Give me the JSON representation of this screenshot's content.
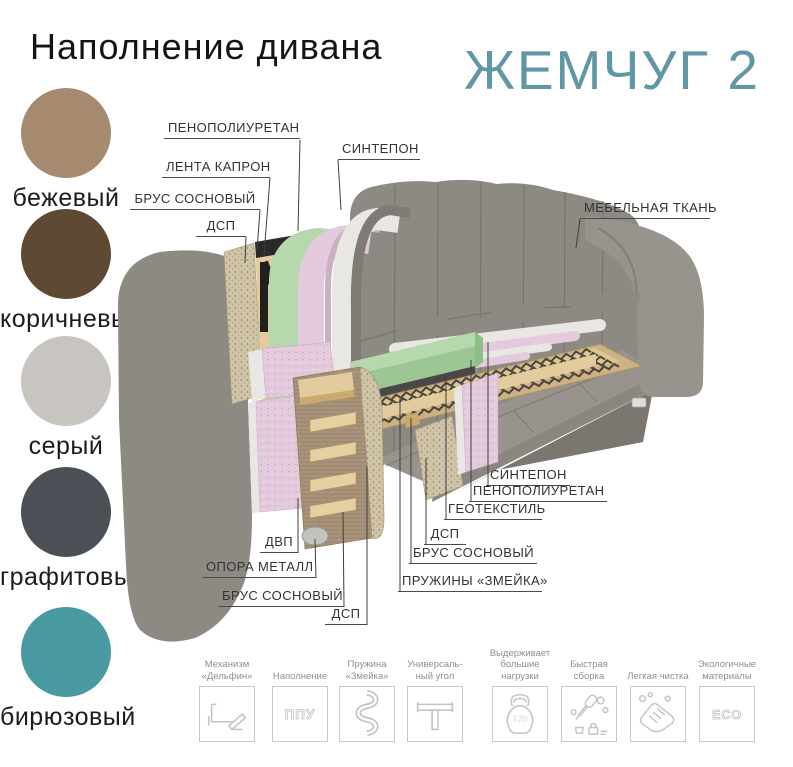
{
  "header": {
    "title": "Наполнение дивана",
    "product": "ЖЕМЧУГ 2"
  },
  "colors": {
    "product_teal": "#6097a4",
    "label_text": "#333333",
    "leader_line": "#3f3f3f",
    "sofa_gray": "#8d8983",
    "sofa_gray_light": "#98948d",
    "sofa_gray_dark": "#7b766f",
    "seam_gray": "#6b675f",
    "foam_green": "#b5d8ac",
    "foam_green_dark": "#9cc794",
    "foam_green_side": "#8fbe86",
    "foam_pink": "#e3cadd",
    "sintepon_white": "#e8e7e3",
    "fabric_edge_gray": "#7e7a74",
    "wood_light": "#e2cb9c",
    "wood_dark": "#c9a96c",
    "chipboard": "#cfc3a8",
    "fiberboard": "#a8937a",
    "strap_black": "#21201e",
    "geotextile_dark": "#4a4846",
    "metal": "#c2c2c0",
    "icon_line": "#c4c4c4",
    "icon_text_gray": "#8f8f8f",
    "box_border": "#c9c9c9"
  },
  "swatches": {
    "items": [
      {
        "label": "бежевый",
        "color": "#a58a6f"
      },
      {
        "label": "коричневый",
        "color": "#5e4a33"
      },
      {
        "label": "серый",
        "color": "#c8c4bf"
      },
      {
        "label": "графитовый",
        "color": "#4b5056"
      },
      {
        "label": "бирюзовый",
        "color": "#4999a1"
      }
    ]
  },
  "diagram": {
    "labels": {
      "pu_top": "ПЕНОПОЛИУРЕТАН",
      "sintepon_top": "СИНТЕПОН",
      "lenta_kapron": "ЛЕНТА КАПРОН",
      "brus_top": "БРУС СОСНОВЫЙ",
      "dsp_top": "ДСП",
      "fabric": "МЕБЕЛЬНАЯ ТКАНЬ",
      "sintepon_seat": "СИНТЕПОН",
      "pu_seat": "ПЕНОПОЛИУРЕТАН",
      "geotextile": "ГЕОТЕКСТИЛЬ",
      "dsp_seat": "ДСП",
      "brus_seat": "БРУС СОСНОВЫЙ",
      "springs": "ПРУЖИНЫ «ЗМЕЙКА»",
      "dvp": "ДВП",
      "opora": "ОПОРА МЕТАЛЛ",
      "brus_arm": "БРУС СОСНОВЫЙ",
      "dsp_arm": "ДСП"
    }
  },
  "features": {
    "items": [
      {
        "label": "Механизм\n«Дельфин»",
        "icon": "dolphin-mechanism-icon"
      },
      {
        "label": "Наполнение",
        "icon": "ppu-icon",
        "icon_text": "ППУ"
      },
      {
        "label": "Пружина\n«Змейка»",
        "icon": "snake-spring-icon"
      },
      {
        "label": "Универсаль-\nный угол",
        "icon": "universal-corner-icon"
      },
      {
        "label": "Выдерживает\nбольшие\nнагрузки",
        "icon": "kettlebell-icon",
        "icon_text": "120"
      },
      {
        "label": "Быстрая\nсборка",
        "icon": "quick-assembly-icon"
      },
      {
        "label": "Легкая чистка",
        "icon": "easy-cleaning-icon"
      },
      {
        "label": "Экологичные\nматериалы",
        "icon": "eco-icon",
        "icon_text": "ECO"
      }
    ]
  }
}
